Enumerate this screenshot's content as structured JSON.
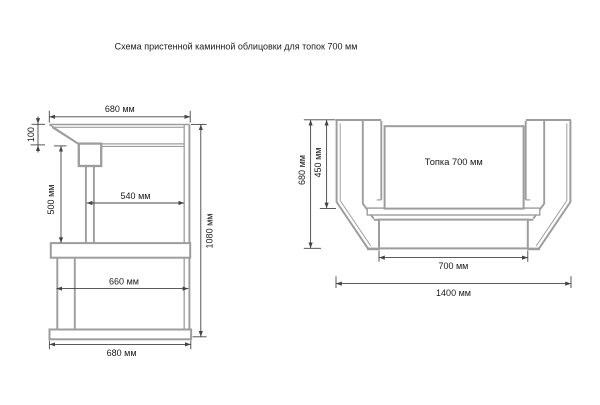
{
  "title": "Схема пристенной каминной облицовки для топок 700 мм",
  "side_view": {
    "dims": {
      "top_width": "680 мм",
      "hood_height": "100",
      "opening_height": "500 мм",
      "opening_width": "540 мм",
      "total_height": "1080 мм",
      "lower_width": "660 мм",
      "base_width": "680 мм"
    }
  },
  "front_view": {
    "firebox_label": "Топка 700 мм",
    "dims": {
      "total_height": "680 мм",
      "firebox_height": "450 мм",
      "firebox_width": "700 мм",
      "total_width": "1400 мм"
    }
  },
  "colors": {
    "background": "#ffffff",
    "structure_line": "#9d9d9d",
    "dimension_line": "#444444",
    "text": "#1a1a1a"
  }
}
